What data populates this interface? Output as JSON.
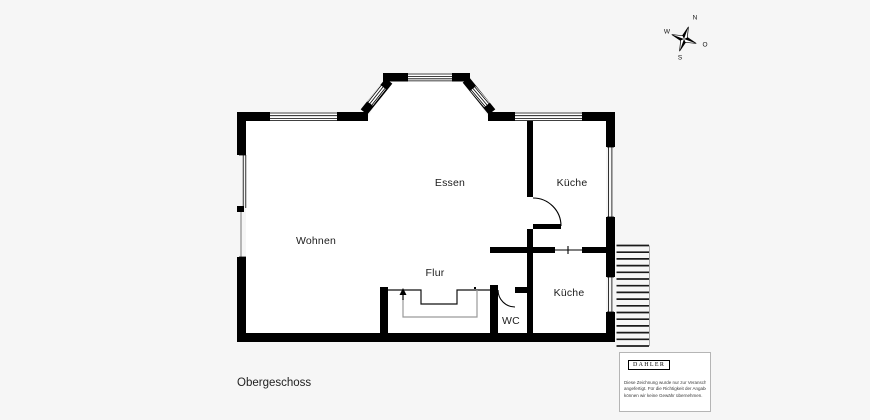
{
  "floor": {
    "title": "Obergeschoss"
  },
  "rooms": [
    {
      "id": "wohnen",
      "label": "Wohnen"
    },
    {
      "id": "essen",
      "label": "Essen"
    },
    {
      "id": "kueche-oben",
      "label": "Küche"
    },
    {
      "id": "flur",
      "label": "Flur"
    },
    {
      "id": "wc",
      "label": "WC"
    },
    {
      "id": "kueche-unten",
      "label": "Küche"
    }
  ],
  "compass": {
    "north": "N",
    "east": "O",
    "south": "S",
    "west": "W"
  },
  "branding": {
    "logo": "DAHLER",
    "disclaimer_lines": [
      "Diese Zeichnung wurde nur zur Veranschaulichung",
      "angefertigt. Für die Richtigkeit der Angaben",
      "können wir keine Gewähr übernehmen."
    ]
  },
  "colors": {
    "wall": "#000000",
    "background": "#f6f6f6",
    "room_fill": "#ffffff",
    "railing": "#9a9a9a",
    "stair_tread": "#1a1a1a"
  }
}
